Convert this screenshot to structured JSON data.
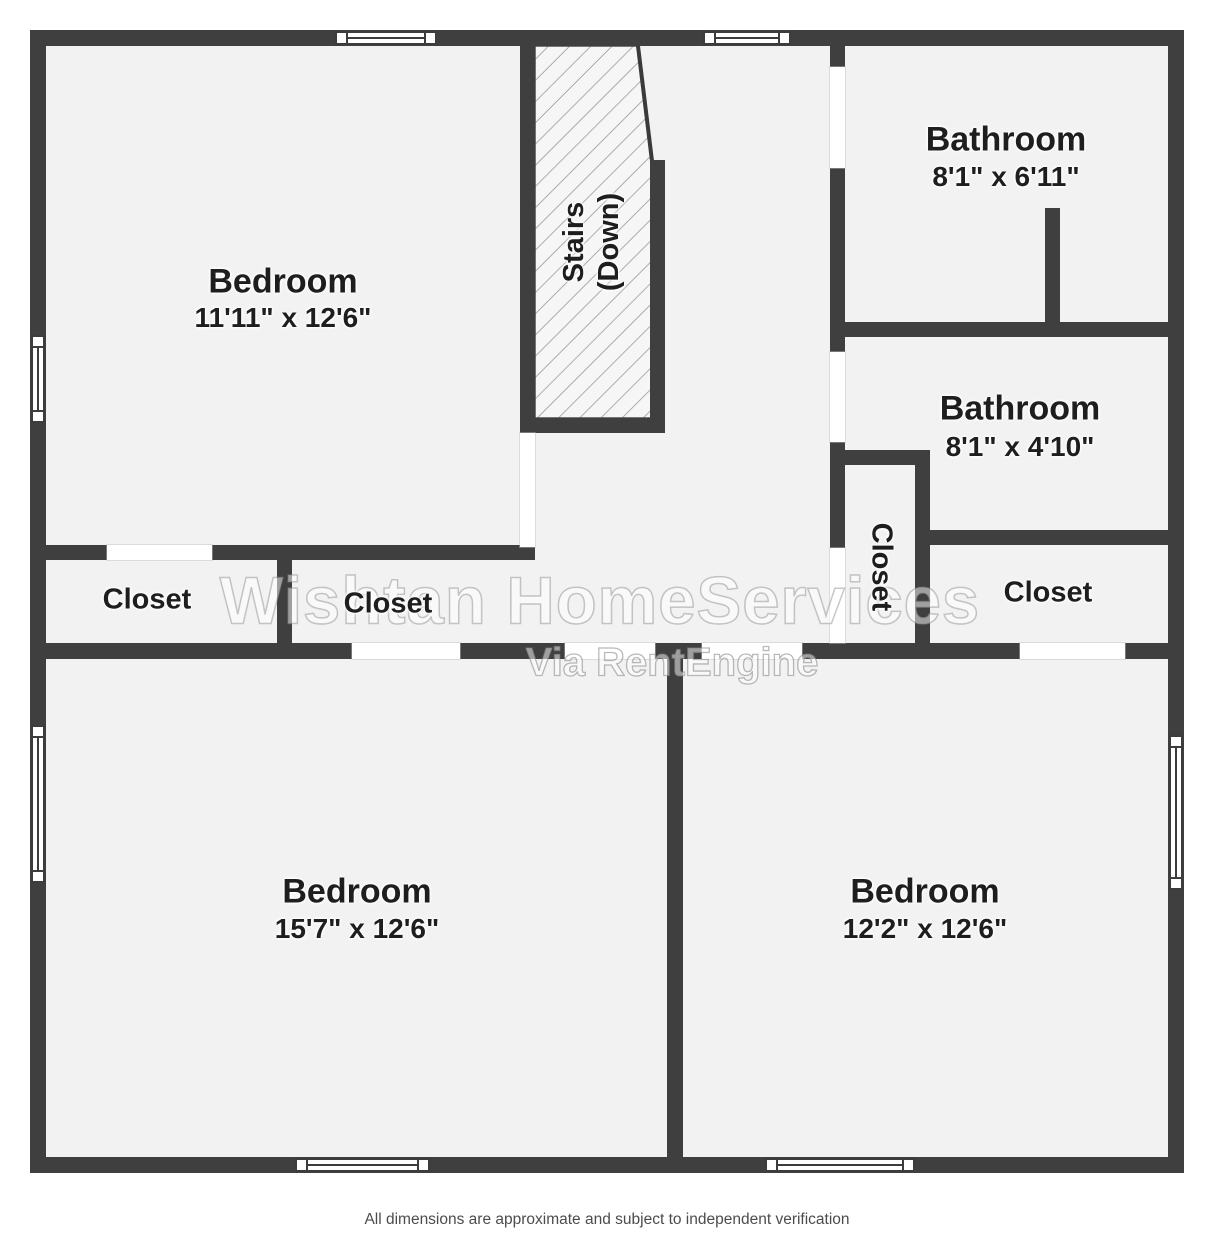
{
  "plan": {
    "stairs": {
      "line1": "Stairs",
      "line2": "(Down)"
    },
    "rooms": [
      {
        "id": "bedroom-top-left",
        "label": "Bedroom",
        "dims": "11'11\" x 12'6\""
      },
      {
        "id": "bathroom-top-right",
        "label": "Bathroom",
        "dims": "8'1\" x 6'11\""
      },
      {
        "id": "bathroom-mid-right",
        "label": "Bathroom",
        "dims": "8'1\" x 4'10\""
      },
      {
        "id": "bedroom-bottom-left",
        "label": "Bedroom",
        "dims": "15'7\" x 12'6\""
      },
      {
        "id": "bedroom-bottom-right",
        "label": "Bedroom",
        "dims": "12'2\" x 12'6\""
      }
    ],
    "closets": [
      {
        "id": "closet-left",
        "label": "Closet"
      },
      {
        "id": "closet-middle",
        "label": "Closet"
      },
      {
        "id": "closet-vertical",
        "label": "Closet"
      },
      {
        "id": "closet-right",
        "label": "Closet"
      }
    ]
  },
  "watermark": {
    "line1": "Wishtan HomeServices",
    "line2": "Via RentEngine"
  },
  "footer": "All dimensions are approximate and subject to independent verification",
  "colors": {
    "wall": "#3f3f3f",
    "floor": "#f2f2f2",
    "hatch_line": "#9a9a9a",
    "footer_text": "#4c4c4c"
  }
}
